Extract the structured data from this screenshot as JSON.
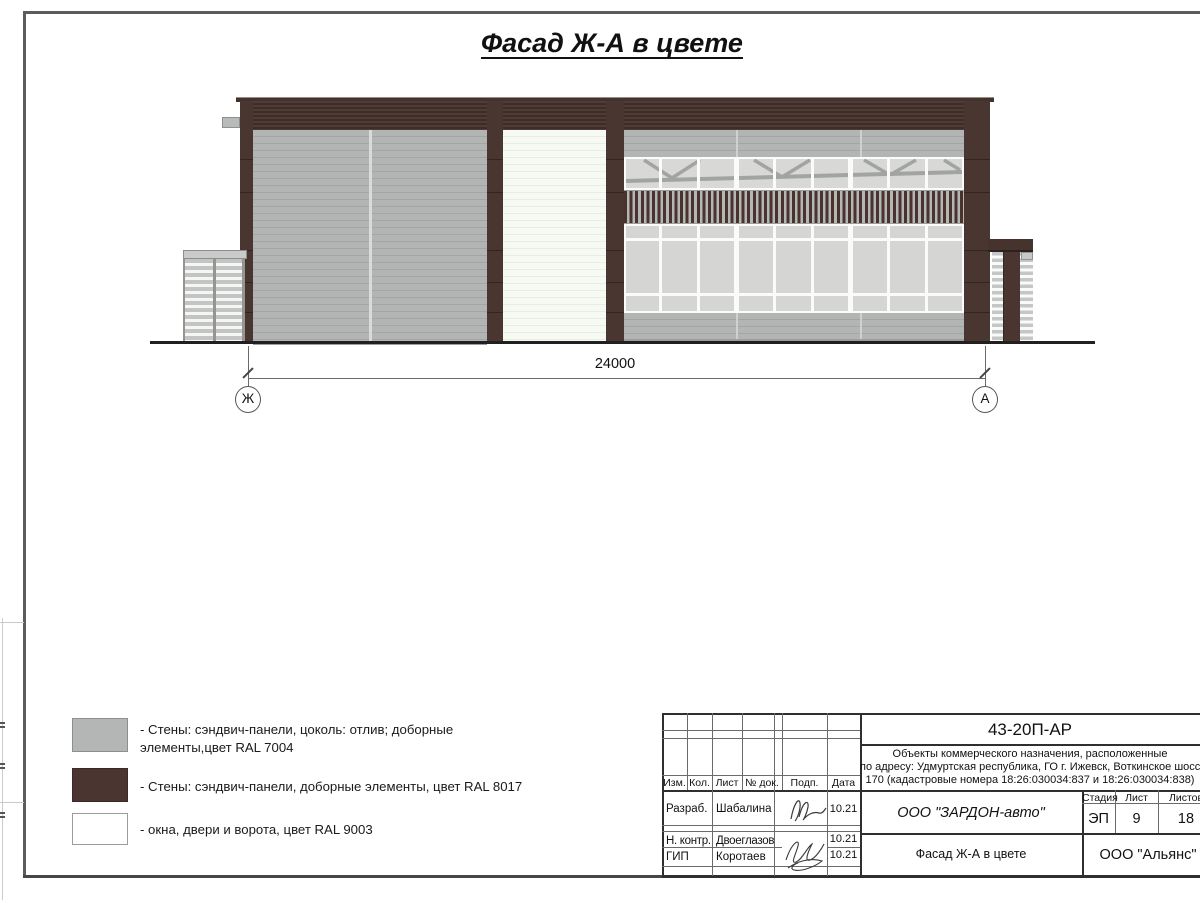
{
  "page": {
    "title": "Фасад Ж-А в цвете"
  },
  "drawing": {
    "dimension_label": "24000",
    "axis_left": "Ж",
    "axis_right": "А"
  },
  "legend": {
    "items": [
      {
        "swatch_color": "#b4b6b5",
        "label": "- Стены: сэндвич-панели, цоколь: отлив; доборные элементы,цвет RAL 7004"
      },
      {
        "swatch_color": "#4a3531",
        "label": "- Стены: сэндвич-панели, доборные элементы, цвет RAL 8017"
      },
      {
        "swatch_color": "#ffffff",
        "label": "- окна, двери и ворота, цвет RAL 9003"
      }
    ]
  },
  "title_block": {
    "doc_number": "43-20П-АР",
    "description_line1": "Объекты коммерческого назначения, расположенные",
    "description_line2": "по адресу: Удмуртская республика, ГО г. Ижевск, Воткинское шоссе,",
    "description_line3": "170 (кадастровые номера 18:26:030034:837 и 18:26:030034:838)",
    "rev_headers": [
      "Изм.",
      "Кол.",
      "Лист",
      "№ док.",
      "Подп.",
      "Дата"
    ],
    "signers": [
      {
        "role": "Разраб.",
        "name": "Шабалина",
        "date": "10.21"
      },
      {
        "role": "Н. контр.",
        "name": "Двоеглазов",
        "date": "10.21"
      },
      {
        "role": "ГИП",
        "name": "Коротаев",
        "date": "10.21"
      }
    ],
    "company": "ООО \"ЗАРДОН-авто\"",
    "sheet_title": "Фасад Ж-А в цвете",
    "stage_label": "Стадия",
    "sheet_label": "Лист",
    "sheets_label": "Листов",
    "stage": "ЭП",
    "sheet_number": "9",
    "sheets_total": "18",
    "firm": "ООО \"Альянс\""
  },
  "materials": {
    "ral_7004": "#b4b6b5",
    "ral_8017": "#4a3531",
    "ral_9003": "#f7faf4"
  }
}
